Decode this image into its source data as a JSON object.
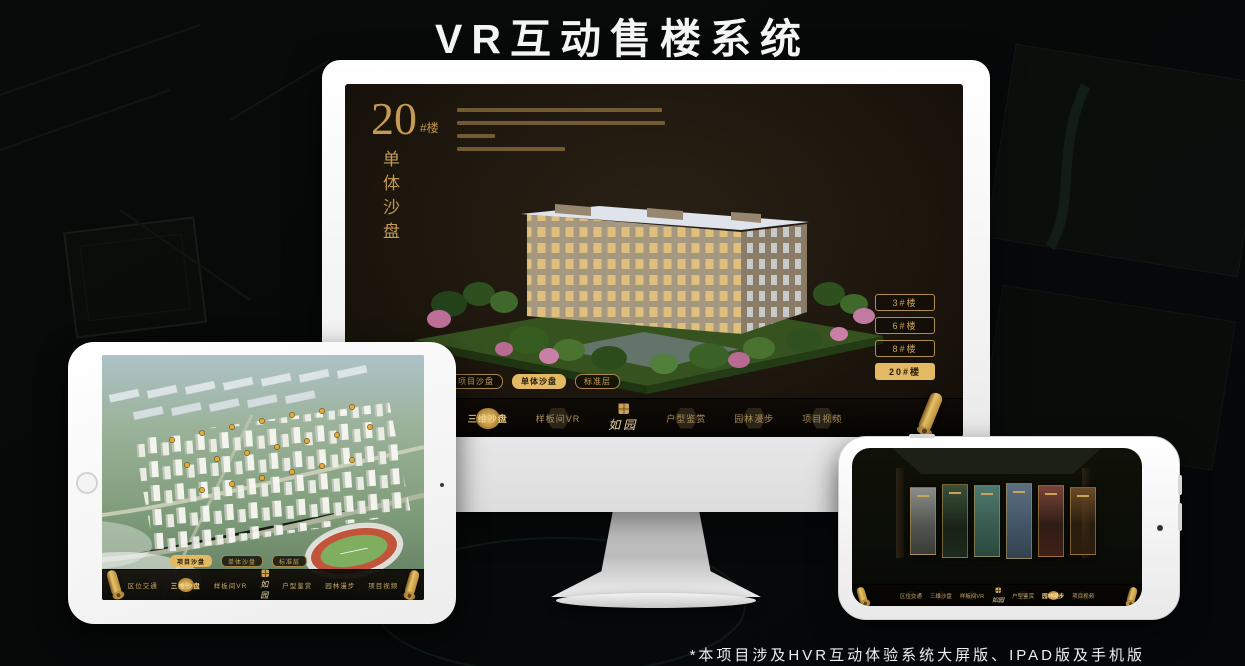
{
  "page": {
    "title": "VR互动售楼系统",
    "footnote": "*本项目涉及HVR互动体验系统大屏版、IPAD版及手机版"
  },
  "colors": {
    "gold": "#c9a158",
    "gold_selected": "#e3b964",
    "screen_background": "#1e170e",
    "nav_label": "#a98f5d"
  },
  "nav": {
    "logo": "如园",
    "items": [
      "区位交通",
      "三维沙盘",
      "样板间VR",
      "户型鉴赏",
      "园林漫步",
      "项目视频"
    ]
  },
  "monitor": {
    "headline": {
      "big": "20",
      "suffix": "#楼",
      "vertical": "单体沙盘"
    },
    "floor_buttons": [
      {
        "label": "3#楼",
        "selected": false
      },
      {
        "label": "6#楼",
        "selected": false
      },
      {
        "label": "8#楼",
        "selected": false
      },
      {
        "label": "20#楼",
        "selected": true
      }
    ],
    "tabs": [
      {
        "label": "项目沙盘",
        "selected": false
      },
      {
        "label": "单体沙盘",
        "selected": true
      },
      {
        "label": "标准层",
        "selected": false
      }
    ],
    "selected_nav": "三维沙盘"
  },
  "tablet": {
    "tabs": [
      {
        "label": "项目沙盘",
        "selected": true
      },
      {
        "label": "单体沙盘",
        "selected": false
      },
      {
        "label": "标准层",
        "selected": false
      }
    ],
    "selected_nav": "三维沙盘"
  },
  "phone": {
    "selected_nav": "园林漫步"
  }
}
